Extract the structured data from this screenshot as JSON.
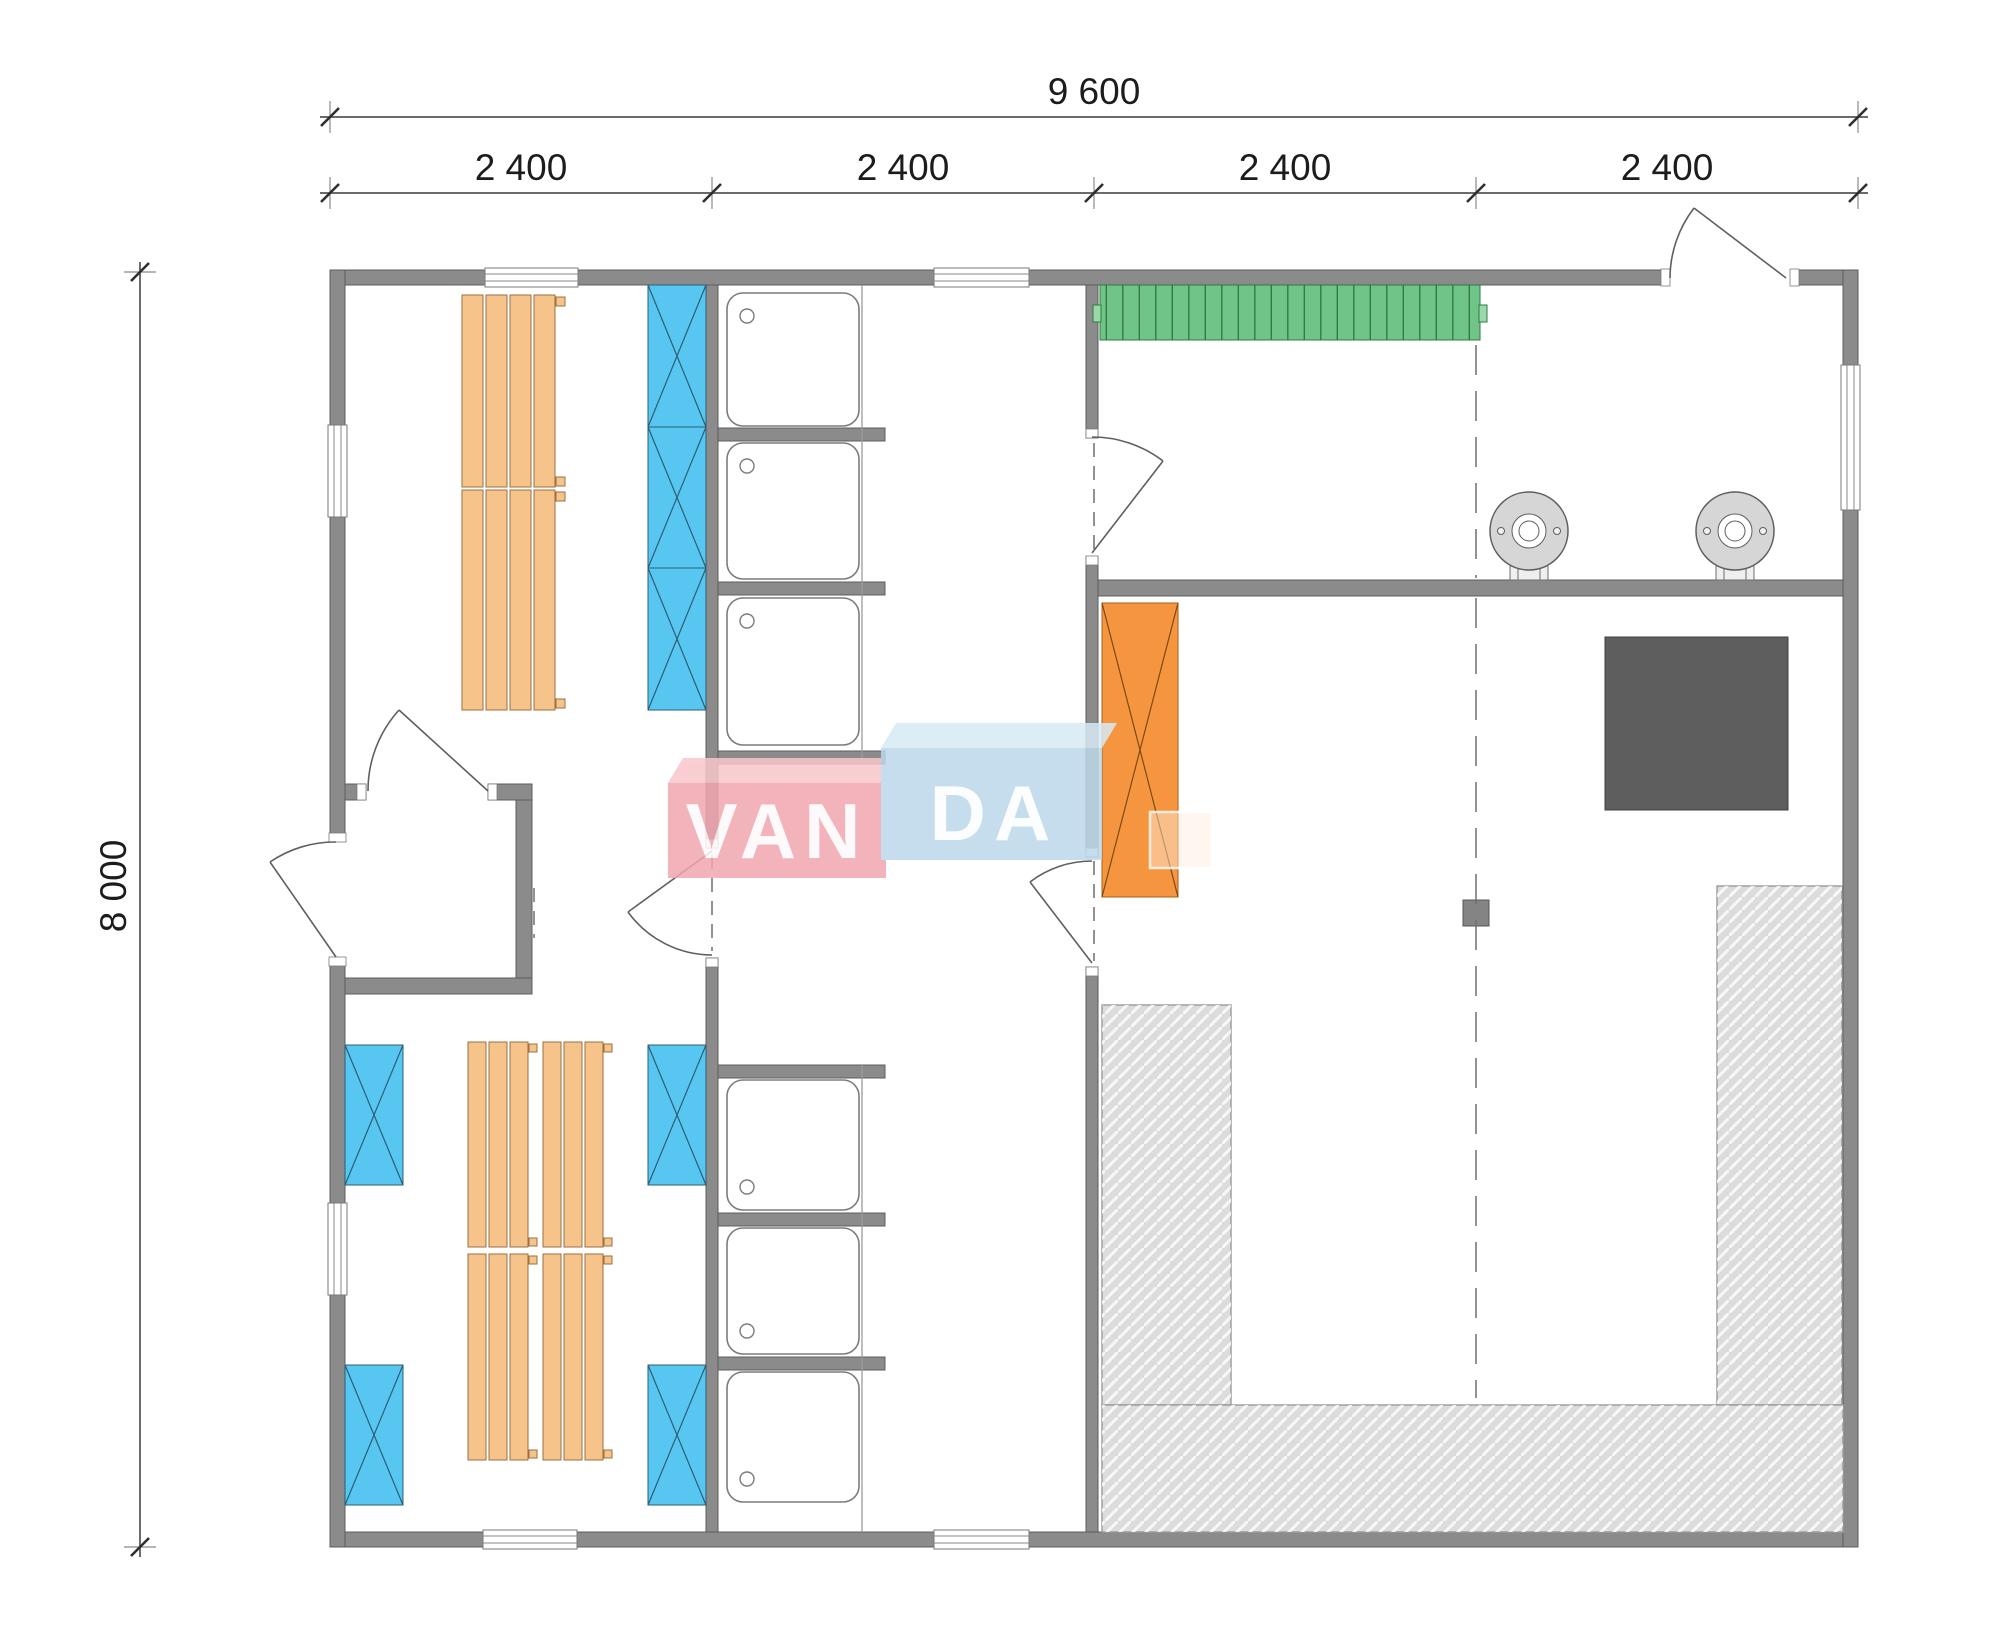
{
  "watermark": {
    "text_left": "VAN",
    "text_right": "DA"
  },
  "dimensions": {
    "overall_width": "9 600",
    "segments": [
      "2 400",
      "2 400",
      "2 400",
      "2 400"
    ],
    "overall_height": "8 000"
  },
  "colors": {
    "wall": "#8b8b8b",
    "bench_wood": "#f6c38b",
    "vent_blue": "#57c7f2",
    "bench_green": "#6fc487",
    "heater_orange": "#f6953f",
    "stove_dark": "#5e5e5e",
    "deck_gray": "#dcdcdc",
    "post_gray": "#848484",
    "fixture_gray": "#d6d6d6",
    "watermark_pink": "#f2a6b0",
    "watermark_pink_top": "#f8c6cc",
    "watermark_blue": "#bdd8ea",
    "watermark_blue_top": "#d8eaf5"
  },
  "fixtures": {
    "shower_tray_count": 6,
    "sauna_bench_plank_groups": 3,
    "blue_marked_units": 7,
    "round_fixture_count": 2,
    "entry_door_count": 2,
    "interior_door_count": 4
  }
}
